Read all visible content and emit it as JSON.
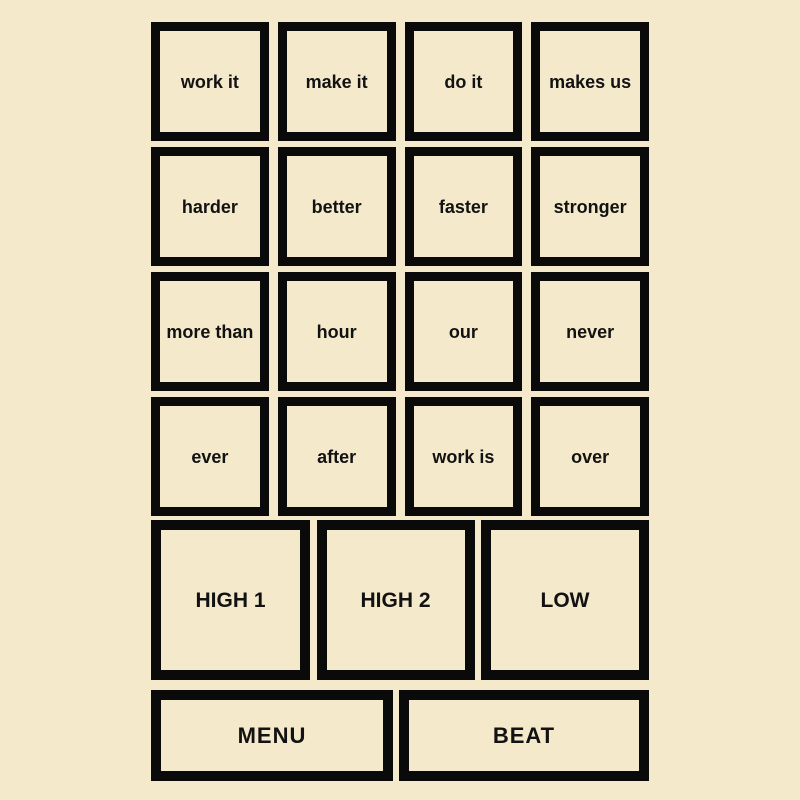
{
  "colors": {
    "background": "#f5e9cb",
    "pad_fill": "#f5e9cb",
    "pad_border": "#0a0a0a",
    "pad_text": "#121212"
  },
  "pads": {
    "words": [
      [
        "work it",
        "make it",
        "do it",
        "makes us"
      ],
      [
        "harder",
        "better",
        "faster",
        "stronger"
      ],
      [
        "more than",
        "hour",
        "our",
        "never"
      ],
      [
        "ever",
        "after",
        "work is",
        "over"
      ]
    ],
    "levels": [
      "HIGH 1",
      "HIGH 2",
      "LOW"
    ],
    "controls": [
      "MENU",
      "BEAT"
    ]
  }
}
